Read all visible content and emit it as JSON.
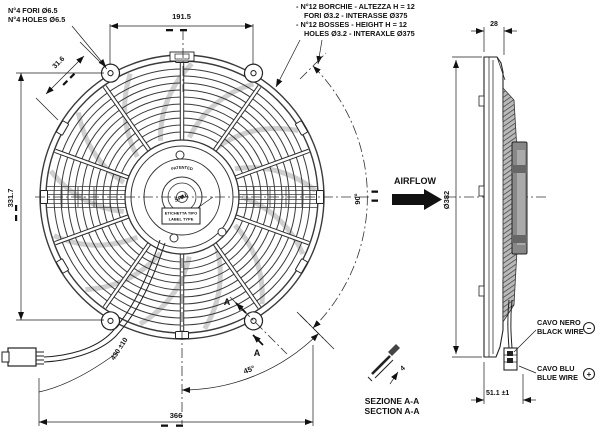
{
  "drawing": {
    "type": "fan-technical-drawing",
    "views": [
      "front",
      "side",
      "section A-A"
    ]
  },
  "notes": {
    "holes_line1": "N°4 FORI Ø6.5",
    "holes_line2": "N°4 HOLES Ø6.5",
    "bosses_line1": "- N°12 BORCHIE - ALTEZZA H = 12",
    "bosses_line2": "FORI Ø3.2 - INTERASSE Ø375",
    "bosses_line3": "- N°12 BOSSES - HEIGHT H = 12",
    "bosses_line4": "HOLES Ø3.2 - INTERAXLE Ø375",
    "airflow": "AIRFLOW",
    "black_wire_line1": "CAVO NERO",
    "black_wire_line2": "BLACK WIRE",
    "black_wire_polarity": "−",
    "blue_wire_line1": "CAVO BLU",
    "blue_wire_line2": "BLUE WIRE",
    "blue_wire_polarity": "+",
    "section_line1": "SEZIONE A-A",
    "section_line2": "SECTION A-A",
    "section_marker": "A",
    "patented": "PATENTED",
    "brand": "SPAL",
    "label_box_line1": "ETICHETTA TIPO",
    "label_box_line2": "LABEL TYPE"
  },
  "dimensions": {
    "top_width": "191.5",
    "side_depth": "28",
    "hole_offset": "31.6",
    "height": "331.7",
    "fan_diameter": "Ø382",
    "angle_90": "90°",
    "angle_45": "45°",
    "wire_length": "430 ±10",
    "bottom_width": "366",
    "total_depth": "51.1 ±1",
    "section_thickness": "4"
  },
  "colors": {
    "line": "#1b1b1b",
    "blade_gray": "#cfcfcf",
    "motor_gray": "#888888",
    "paper": "#ffffff"
  }
}
